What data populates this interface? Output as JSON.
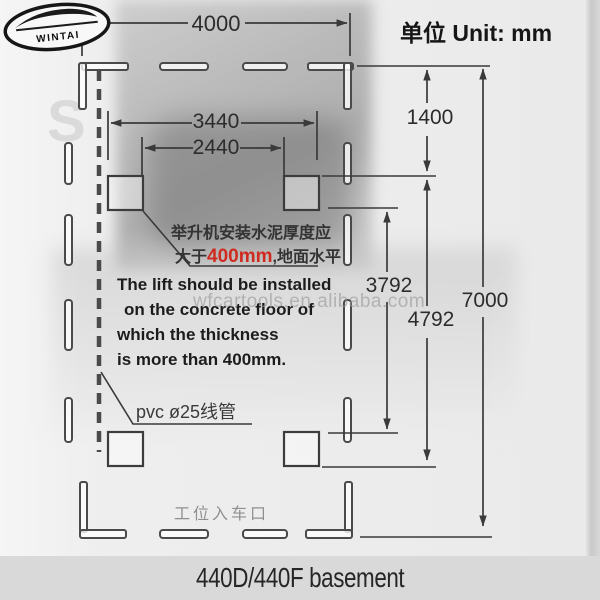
{
  "logo": {
    "brand": "WINTAI"
  },
  "header": {
    "unit_label": "单位 Unit: mm"
  },
  "dimensions": {
    "top_width": "4000",
    "post_outer_width": "3440",
    "post_inner_width": "2440",
    "front_offset": "1400",
    "post_inner_length": "3792",
    "post_outer_length": "4792",
    "total_length": "7000"
  },
  "annotations": {
    "concrete_cn_line1": "举升机安装水泥厚度应",
    "concrete_cn_line2_prefix": "大于",
    "concrete_cn_line2_red": "400mm",
    "concrete_cn_line2_suffix": ",地面水平",
    "concrete_en_lines": [
      "The lift should be installed",
      "on the concrete floor of",
      "which the thickness",
      "is more than 400mm."
    ],
    "pvc_label": "pvc ø25线管",
    "entrance_label": "工位入车口"
  },
  "watermark": {
    "site": "wfcartools.en.alibaba.com",
    "background_letters": [
      "S",
      "S"
    ]
  },
  "footer": {
    "caption": "440D/440F basement"
  },
  "colors": {
    "accent_red": "#cf2b20",
    "line_color": "#3a3a3a",
    "footer_band": "#d9d9d9"
  }
}
